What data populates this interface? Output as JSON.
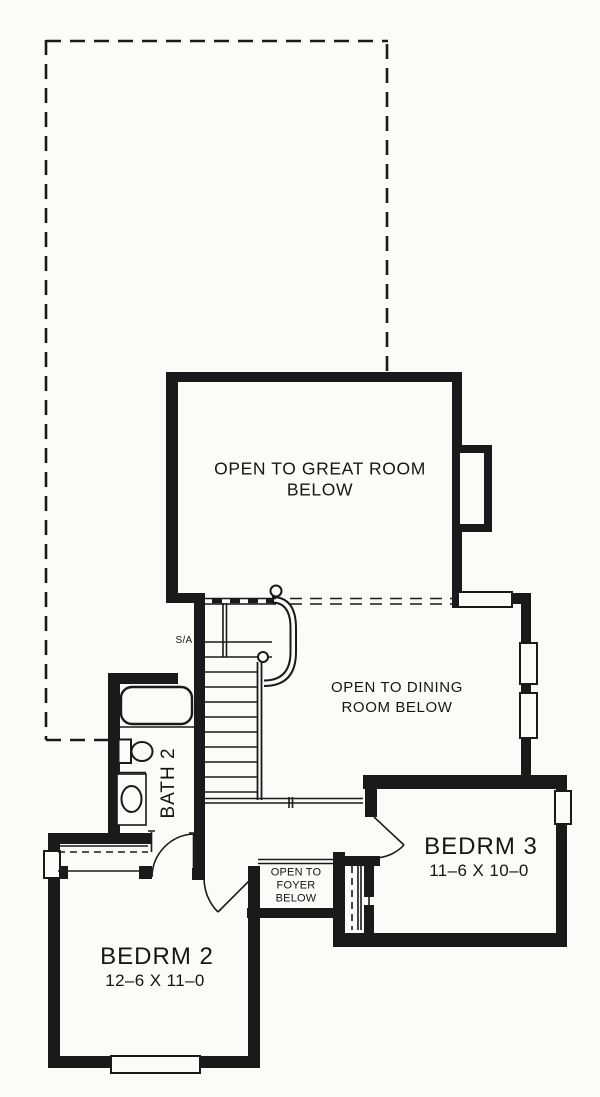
{
  "plan": {
    "title": "Second floor plan",
    "colors": {
      "line": "#1a1a1a",
      "paper": "#fcfbf8"
    },
    "rooms": {
      "great_room": {
        "label": "OPEN TO GREAT ROOM BELOW"
      },
      "dining": {
        "label": "OPEN TO DINING\nROOM BELOW"
      },
      "foyer": {
        "label": "OPEN TO\nFOYER\nBELOW"
      },
      "bath": {
        "label": "BATH 2"
      },
      "bedroom2": {
        "label": "BEDRM 2",
        "dimensions": "12–6 X 11–0"
      },
      "bedroom3": {
        "label": "BEDRM 3",
        "dimensions": "11–6 X 10–0"
      },
      "smoke_alarm": {
        "label": "S/A"
      }
    }
  }
}
